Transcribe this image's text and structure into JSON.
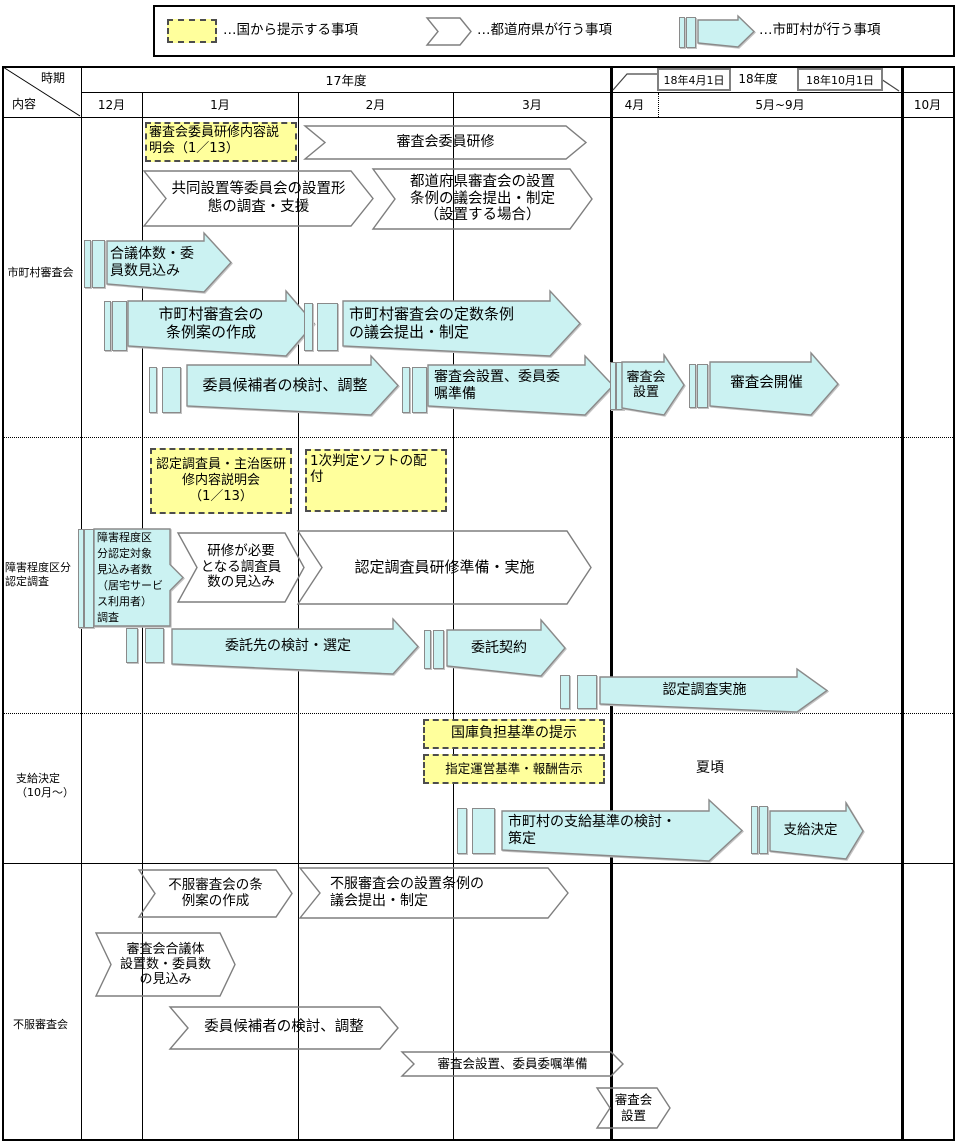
{
  "colors": {
    "national_fill": "#FFFF9C",
    "municipality_fill": "#CBF2F2",
    "shape_stroke": "#7e7e7e"
  },
  "legend": {
    "national": "…国から提示する事項",
    "prefecture": "…都道府県が行う事項",
    "municipality": "…市町村が行う事項"
  },
  "header": {
    "axis_top": "時期",
    "axis_left": "内容",
    "fy17": "17年度",
    "fy18": "18年度",
    "callout_apr": "18年4月1日",
    "callout_oct": "18年10月1日",
    "months": [
      "12月",
      "1月",
      "2月",
      "3月",
      "4月",
      "5月~9月",
      "10月"
    ]
  },
  "rows": {
    "r1": {
      "label": "市町村審査会",
      "training_briefing": "審査会委員研修内容説\n明会（1／13）",
      "member_training": "審査会委員研修",
      "joint_setup_survey": "共同設置等委員会の設置形\n態の調査・支援",
      "pref_ordinance": "都道府県審査会の設置\n条例の議会提出・制定\n（設置する場合）",
      "body_estimate": "合議体数・委\n員数見込み",
      "ordinance_draft": "市町村審査会の\n条例案の作成",
      "quota_ordinance": "市町村審査会の定数条例\nの議会提出・制定",
      "candidate_review": "委員候補者の検討、調整",
      "setup_prep": "審査会設置、委員委\n嘱準備",
      "setup": "審査会\n設置",
      "holding": "審査会開催"
    },
    "r2": {
      "label": "障害程度区分\n認定調査",
      "survey_briefing": "認定調査員・主治医研\n修内容説明会\n（1／13）",
      "software_distribution": "1次判定ソフトの配\n付",
      "target_survey": "障害程度区\n分認定対象\n見込み者数\n（居宅サービ\nス利用者）\n調査",
      "surveyor_estimate": "研修が必要\nとなる調査員\n数の見込み",
      "surveyor_training": "認定調査員研修準備・実施",
      "outsourcing_review": "委託先の検討・選定",
      "outsourcing_contract": "委託契約",
      "survey_execution": "認定調査実施"
    },
    "r3": {
      "label": "支給決定\n（10月～）",
      "treasury_standard": "国庫負担基準の提示",
      "operation_standard": "指定運営基準・報酬告示",
      "summer": "夏頃",
      "payment_standard": "市町村の支給基準の検討・\n策定",
      "payment_decision": "支給決定"
    },
    "r4": {
      "label": "不服審査会",
      "ordinance_draft": "不服審査会の条\n例案の作成",
      "ordinance_assembly": "不服審査会の設置条例の\n議会提出・制定",
      "body_estimate": "審査会合議体\n設置数・委員数\nの見込み",
      "candidate_review": "委員候補者の検討、調整",
      "setup_prep": "審査会設置、委員委嘱準備",
      "setup": "審査会\n設置"
    }
  }
}
